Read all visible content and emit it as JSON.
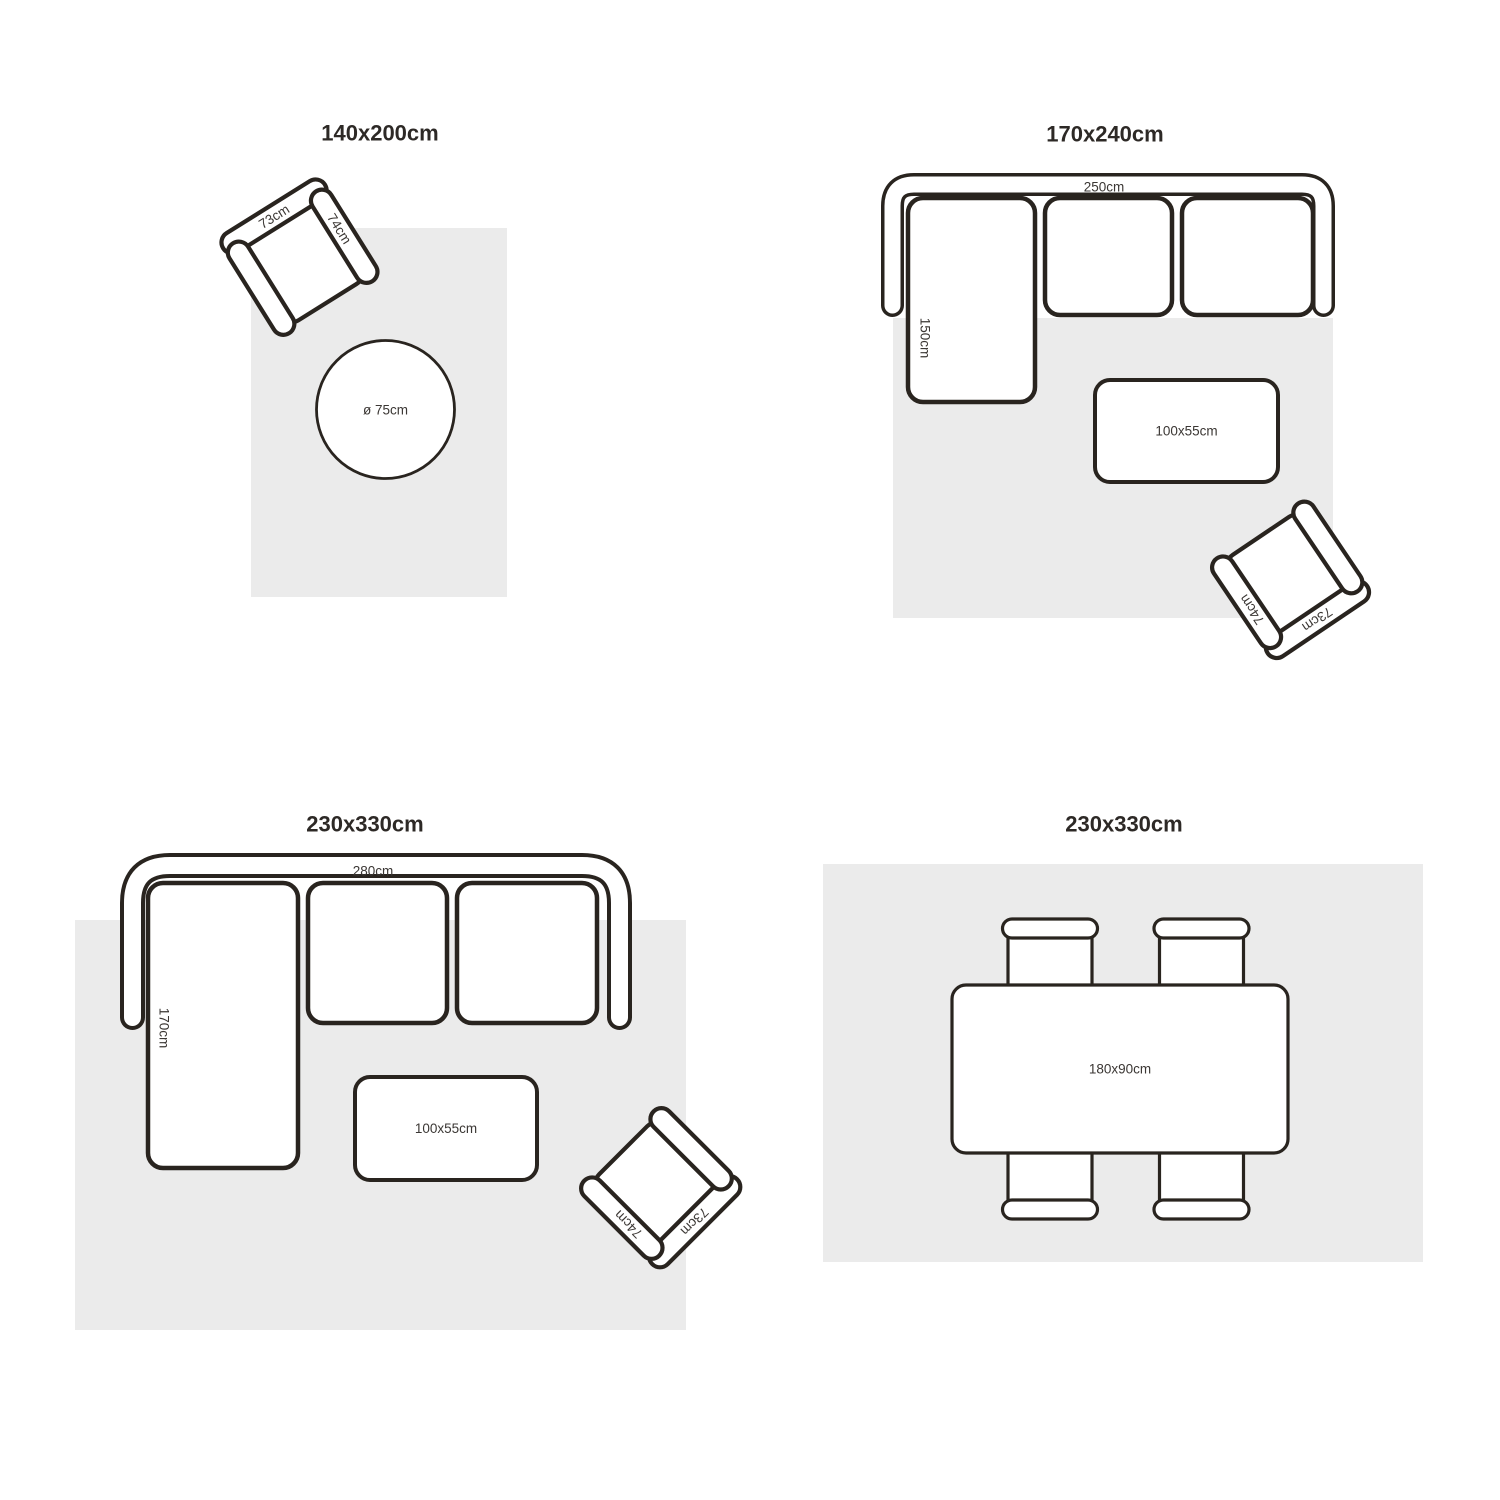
{
  "colors": {
    "outline": "#29241f",
    "rug": "#ebebeb",
    "furn": "#ffffff",
    "label": "#3b3734",
    "title": "#2d2926",
    "background": "#ffffff"
  },
  "panels": [
    {
      "title": "140x200cm",
      "armchair": {
        "back_label": "73cm",
        "arm_label": "74cm"
      },
      "round_table": {
        "label": "ø 75cm"
      }
    },
    {
      "title": "170x240cm",
      "sofa": {
        "width_label": "250cm",
        "depth_label": "150cm"
      },
      "coffee_table": {
        "label": "100x55cm"
      },
      "armchair": {
        "back_label": "73cm",
        "arm_label": "74cm"
      }
    },
    {
      "title": "230x330cm",
      "sofa": {
        "width_label": "280cm",
        "depth_label": "170cm"
      },
      "coffee_table": {
        "label": "100x55cm"
      },
      "armchair": {
        "back_label": "73cm",
        "arm_label": "74cm"
      }
    },
    {
      "title": "230x330cm",
      "dining_table": {
        "label": "180x90cm"
      }
    }
  ]
}
